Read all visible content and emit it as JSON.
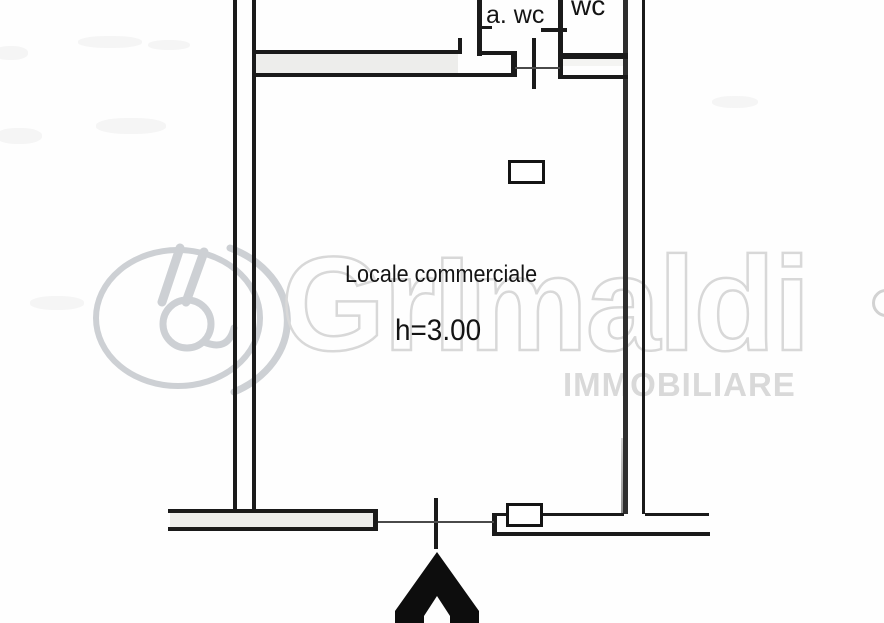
{
  "document": {
    "kind": "scanned floor plan",
    "language": "it"
  },
  "rooms": {
    "awc_label": "a. wc",
    "wc_label": "wc",
    "main_label": "Locale commerciale",
    "main_height_note": "h=3.00"
  },
  "watermark": {
    "brand": "GrImaldi",
    "subtitle": "IMMOBILIARE"
  },
  "icons": {
    "entrance_arrow": "entrance-arrow-icon",
    "door_swing": "door-mark-icon",
    "logo": "grimaldi-logo-icon"
  },
  "colors": {
    "wall": "#1a1a1a",
    "watermark_gray": "#d8d8d8",
    "paper": "#fefefe"
  }
}
